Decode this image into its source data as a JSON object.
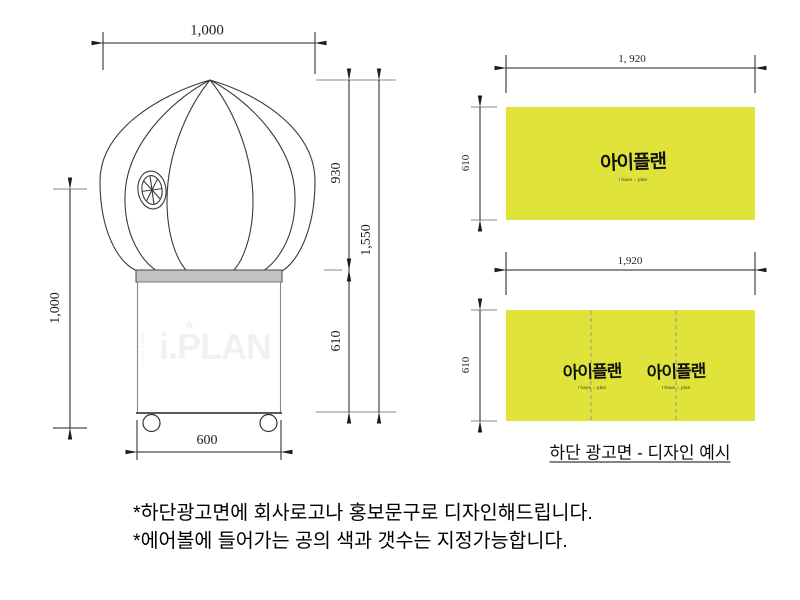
{
  "drawing": {
    "dim_top_width": "1,000",
    "dim_left_height": "1,000",
    "dim_balloon_height": "930",
    "dim_total_height": "1,550",
    "dim_base_height": "610",
    "dim_base_width": "600",
    "watermark": {
      "star": "★",
      "text": "i.PLAN",
      "tagline": "I have a plan"
    }
  },
  "banners": {
    "top_banner": {
      "width_label": "1, 920",
      "height_label": "610"
    },
    "bottom_banner": {
      "width_label": "1,920",
      "height_label": "610"
    },
    "caption": "하단 광고면 - 디자인 예시"
  },
  "logo": {
    "text": "아이플랜",
    "sub_p1": "I have",
    "sub_p2": "a",
    "sub_p3": "plan"
  },
  "notes": {
    "line1": "*하단광고면에 회사로고나 홍보문구로 디자인해드립니다.",
    "line2": "*에어볼에 들어가는 공의 색과 갯수는 지정가능합니다."
  },
  "colors": {
    "banner_yellow": "#dfe33a",
    "band_gray": "#c2c2c2",
    "line_dark": "#2e2e2e",
    "ext_gray": "#8a8a8a",
    "fold_dash": "#9a9a8a",
    "watermark_gray": "#f1f1f1",
    "subtitle_accent": "#f39c12"
  }
}
